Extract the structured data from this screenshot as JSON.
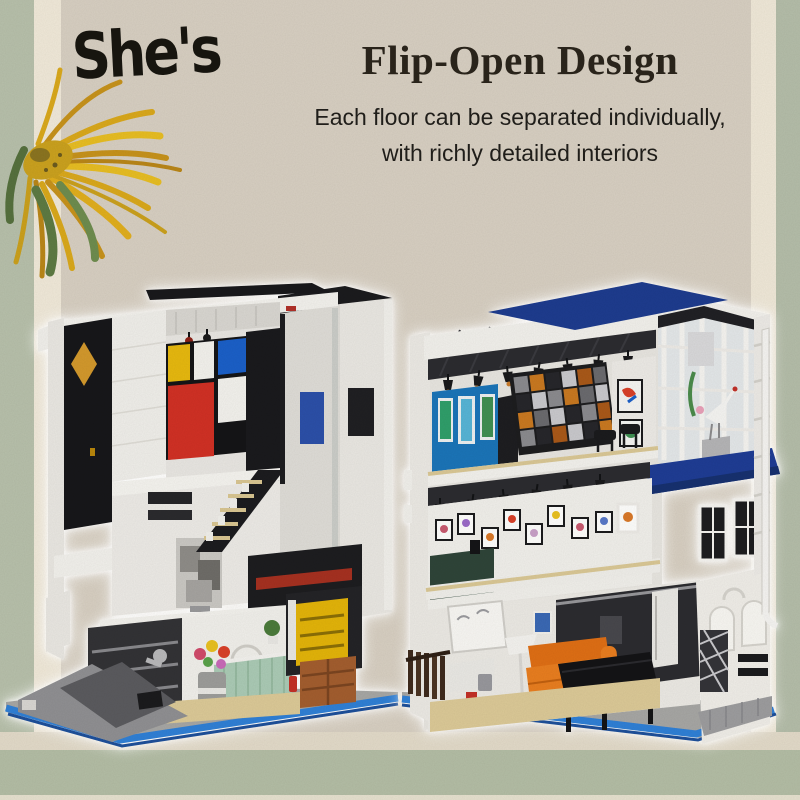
{
  "brand": {
    "logo_text": "She's"
  },
  "header": {
    "title": "Flip-Open Design",
    "subtitle_line1": "Each floor can be separated individually,",
    "subtitle_line2": "with richly detailed interiors"
  },
  "palette": {
    "paper": "#d7cfc2",
    "cream_strip": "#f0e9d9",
    "sage_strip": "#b7c0ab",
    "bottom_band": "#b3bda5",
    "ink": "#17150f",
    "title_color": "#2a241b",
    "mondrian_red": "#d03024",
    "mondrian_blue": "#1a5fc8",
    "mondrian_yellow": "#e6b80e",
    "diamond_gold": "#d2982c",
    "gallery_blue": "#1a74b8",
    "roof_blue": "#1d3b8e",
    "awning_blue": "#1e3c94",
    "sofa_orange": "#e87d1f",
    "counter_mint": "#aacab5",
    "box_yellow": "#e2b309",
    "crate_brown": "#a25d2e",
    "base_blue": "#2f7fd6",
    "sunflower_yellow": "#e3b81f",
    "leaf_green": "#5d7a42"
  },
  "scene": {
    "product": "Flip-open modular brick building set, both halves hinged open to reveal furnished interiors",
    "left_building": {
      "label": "black-and-white art studio half",
      "elements": [
        "mondrian-style mural",
        "gold diamond inlay",
        "ceiling spotlights",
        "open staircase with framed prints",
        "abstract gray sculpture",
        "flower vase",
        "mint tiled counter",
        "arched doorway with plant",
        "yellow shelf unit",
        "wooden crates",
        "fire extinguisher",
        "grey utility ramp",
        "blue-trimmed base"
      ],
      "notes": "black side facade, white brick shell"
    },
    "right_building": {
      "label": "white gallery house half",
      "elements": [
        "navy roof banner",
        "track lighting",
        "blue gallery wall with botanical prints",
        "tessellated feature wall",
        "glass corner atrium with crane sculpture",
        "navy awning",
        "spotlit picture wall",
        "floor lamp",
        "orange sofa",
        "grand piano",
        "garden fence",
        "arched corner facade",
        "lattice panel",
        "downpipe",
        "blue-trimmed base"
      ],
      "notes": "white shell with dark blue accents"
    },
    "decor": {
      "corner_flower": "dried sunflower illustration",
      "background": "layered collage paper with green edge strips"
    }
  }
}
